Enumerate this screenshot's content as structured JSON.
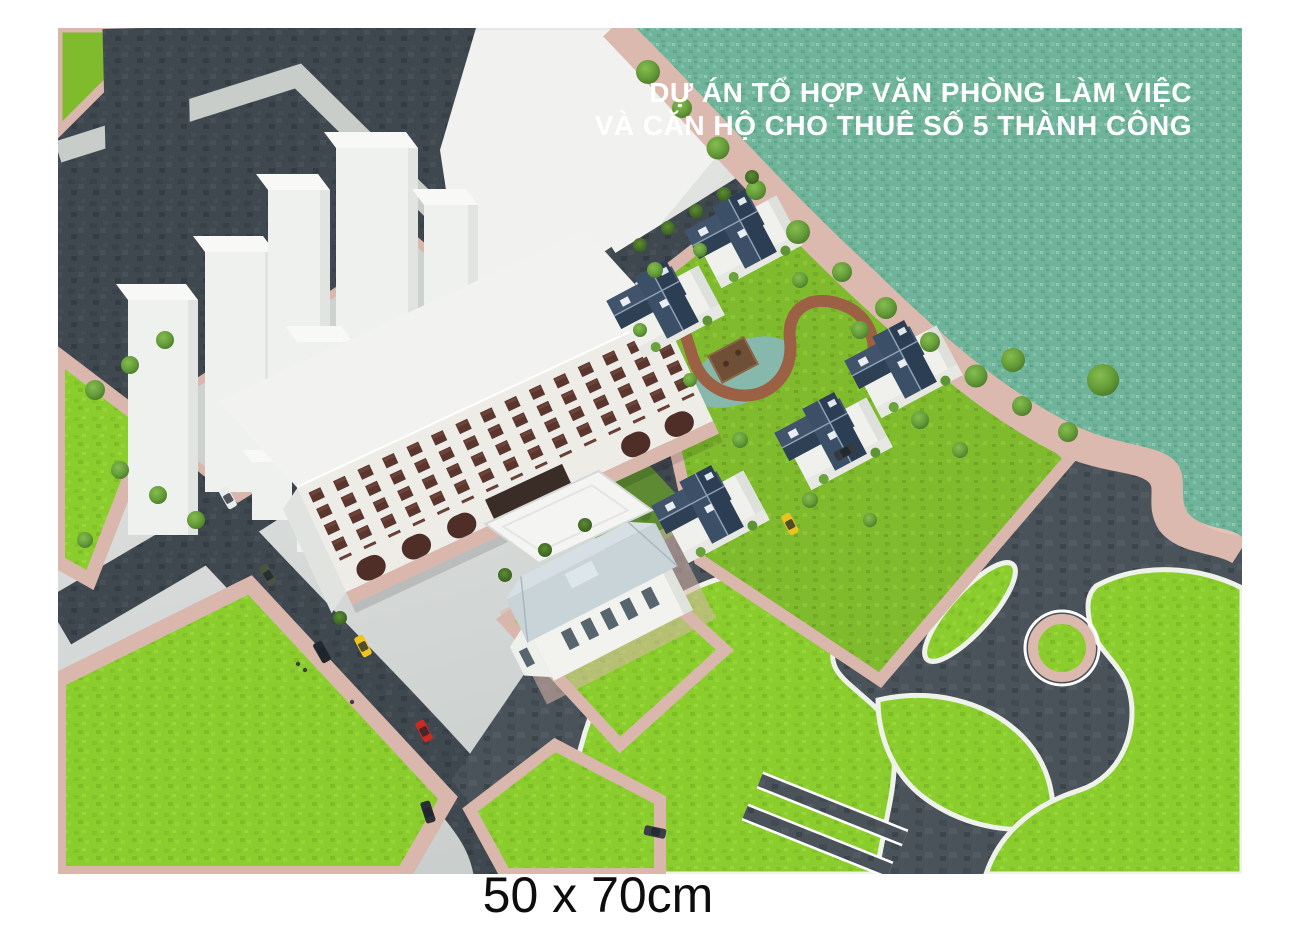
{
  "poster": {
    "title": {
      "line1": "DỰ ÁN TỔ HỢP VĂN PHÒNG LÀM VIỆC",
      "line2": "VÀ CĂN HỘ CHO THUÊ SỐ 5 THÀNH CÔNG"
    },
    "size_caption": "50 x 70cm"
  },
  "scene": {
    "type": "aerial 3d architectural rendering",
    "villas_count": 5,
    "palette": {
      "lake_water": "#6fb49a",
      "park_grass": "#8ccd2e",
      "villa_block_grass": "#7fbb2d",
      "road_asphalt": "#40484f",
      "plaza_asphalt": "#474f56",
      "sidewalk_pink": "#d9b7ac",
      "building_white": "#f1f2ee",
      "villa_roof_blue": "#35485d",
      "office_window_maroon": "#5a362e",
      "taxi_yellow": "#eec51c",
      "car_red": "#c92a21",
      "title_text": "#ffffff",
      "caption_text": "#0d0d0d"
    }
  }
}
